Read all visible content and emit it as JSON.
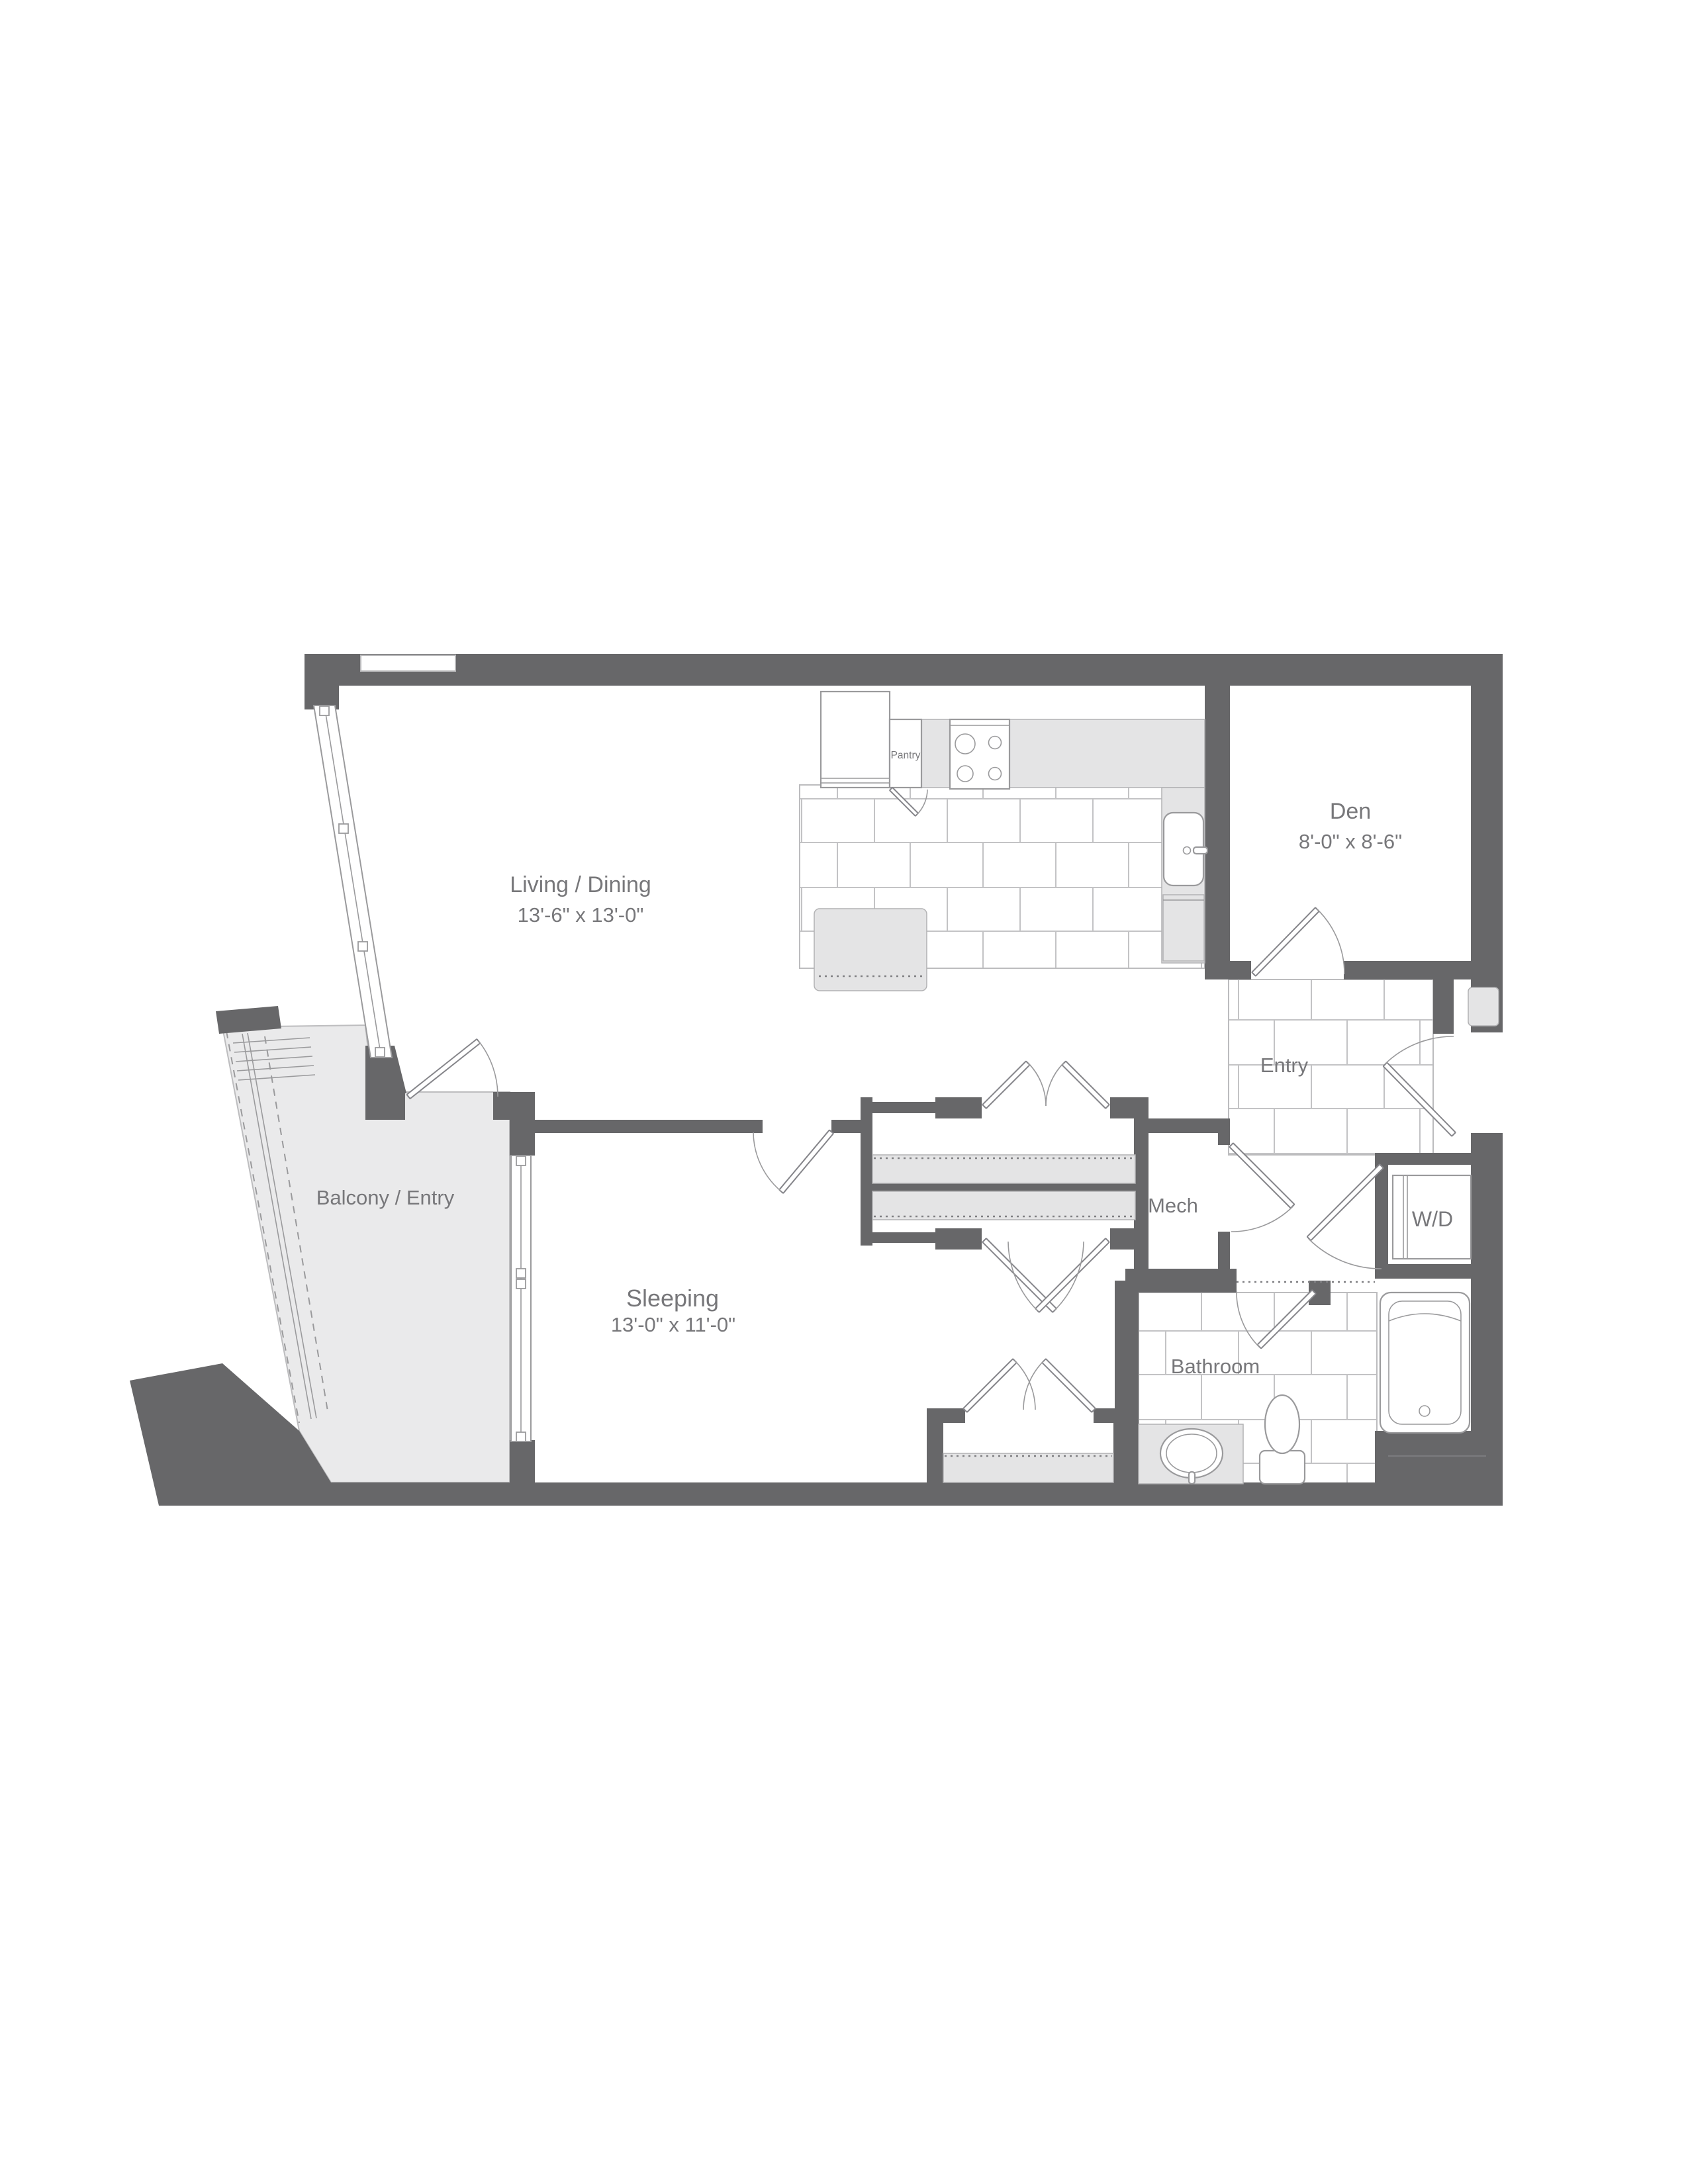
{
  "plan_title": "One-bedroom apartment floor plan",
  "colors": {
    "wall": "#676769",
    "floor_tint": "#e4e4e5",
    "balcony_floor": "#eaeaeb",
    "tile_line": "#c3c3c5",
    "label_text": "#77777a",
    "fixture_line": "#9a9a9c"
  },
  "rooms": {
    "living": {
      "name": "Living / Dining",
      "dims": "13'-6\" x 13'-0\""
    },
    "den": {
      "name": "Den",
      "dims": "8'-0\" x 8'-6\""
    },
    "entry": {
      "name": "Entry"
    },
    "mech": {
      "name": "Mech"
    },
    "wd": {
      "name": "W/D"
    },
    "bathroom": {
      "name": "Bathroom"
    },
    "sleeping": {
      "name": "Sleeping",
      "dims": "13'-0\" x 11'-0\""
    },
    "balcony": {
      "name": "Balcony / Entry"
    },
    "pantry": {
      "name": "Pantry"
    }
  }
}
